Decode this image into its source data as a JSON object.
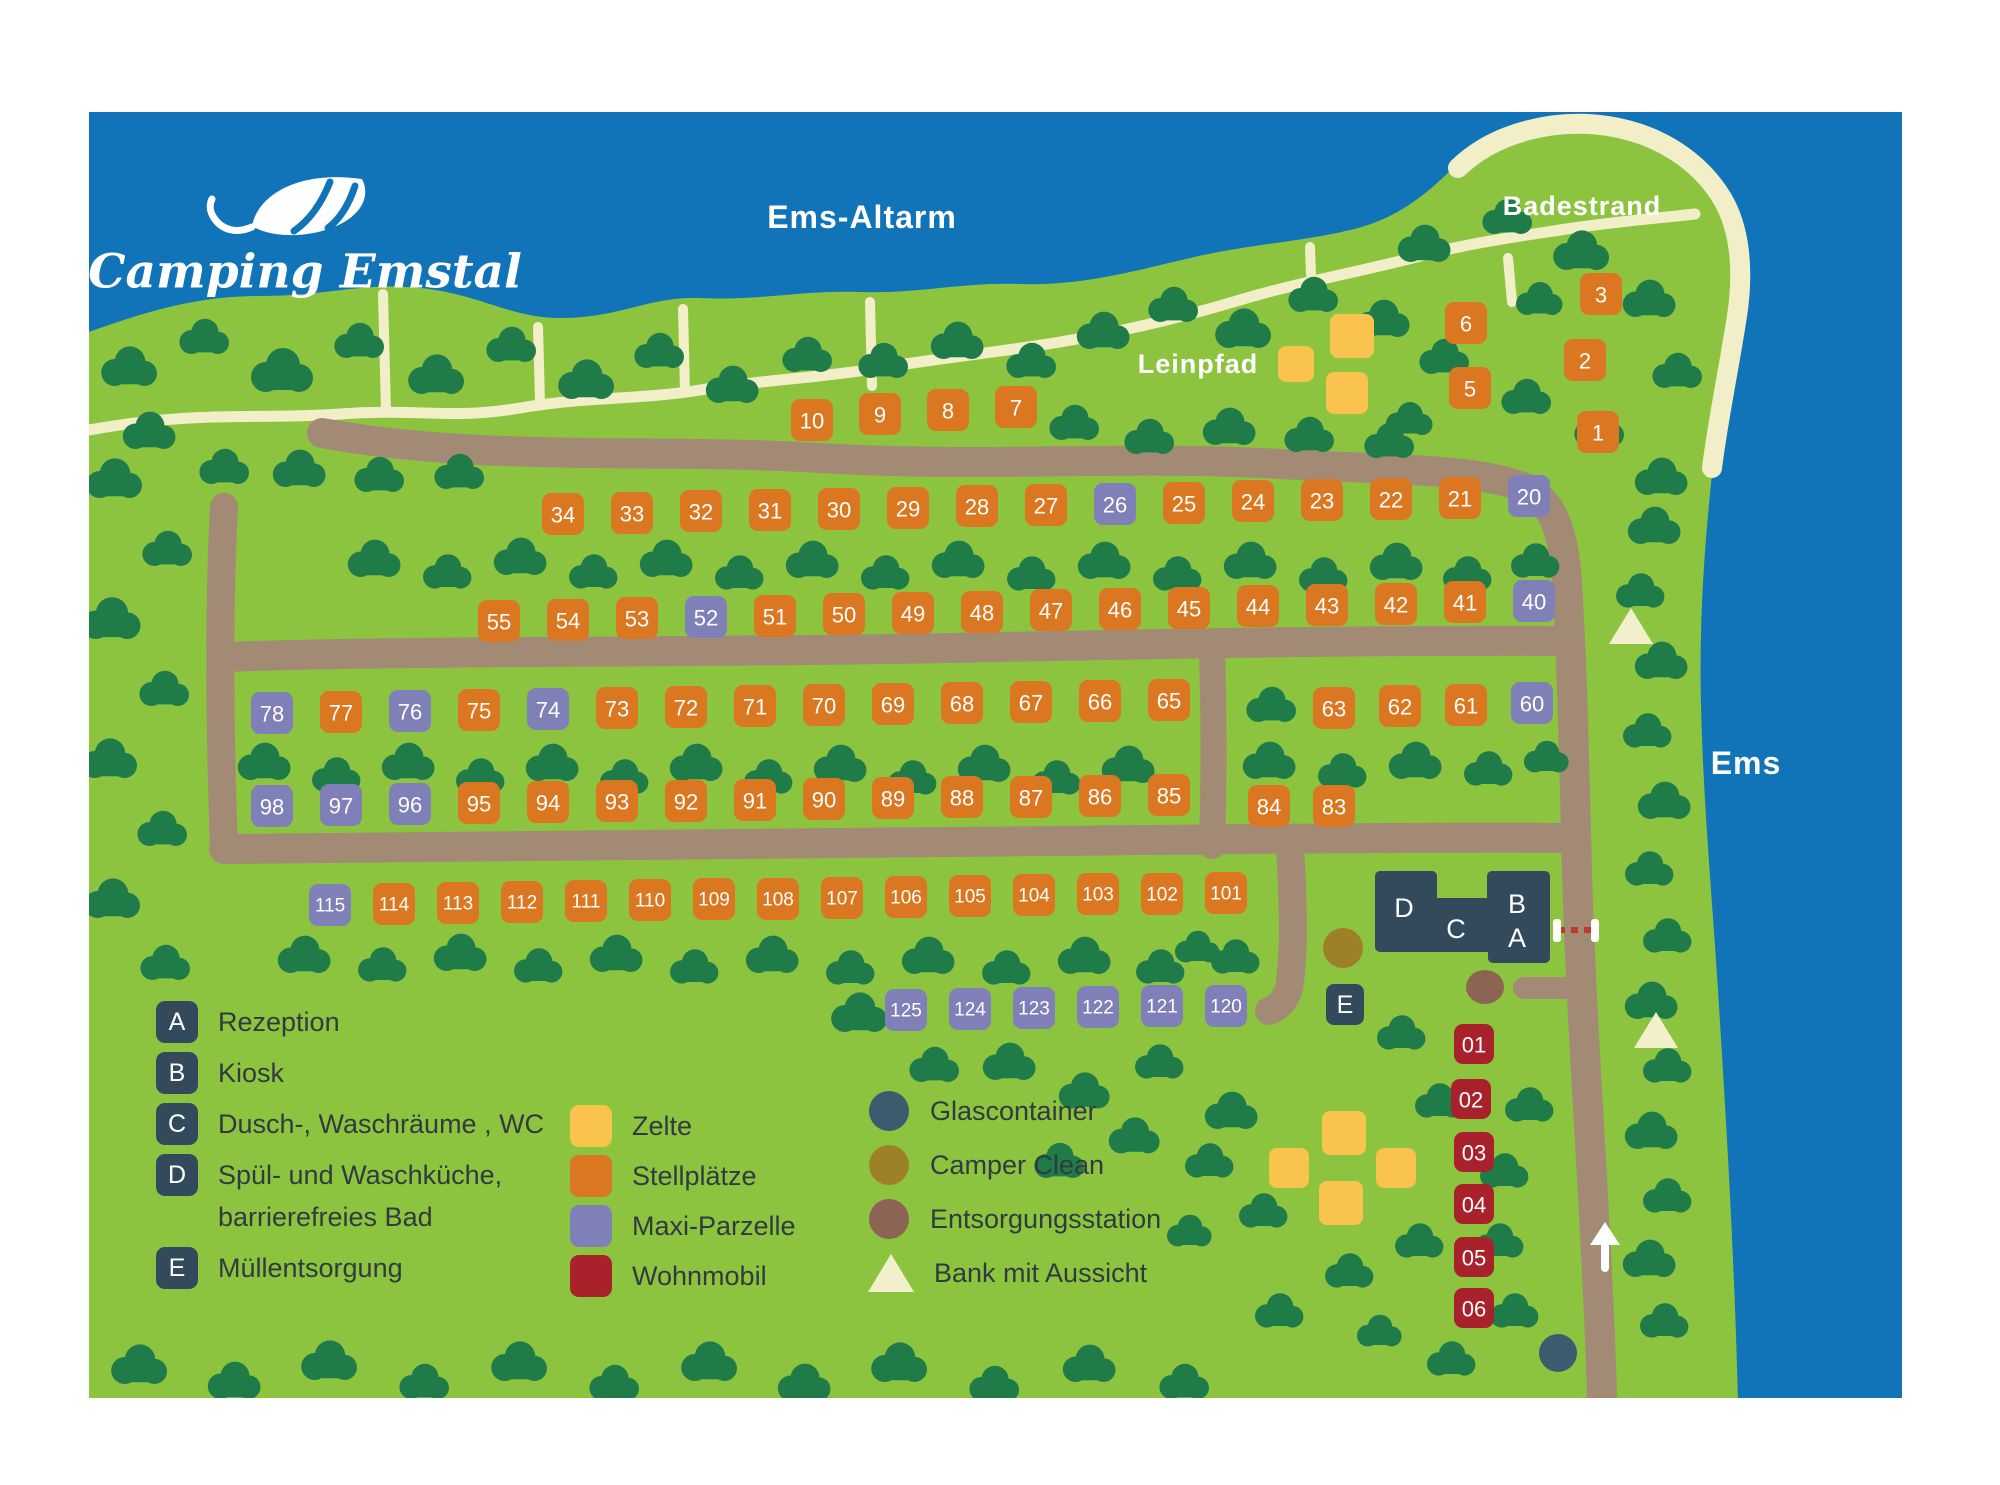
{
  "logo": {
    "title": "Camping Emstal"
  },
  "labels": {
    "water_top": "Ems-Altarm",
    "beach": "Badestrand",
    "towpath": "Leinpfad",
    "river": "Ems"
  },
  "buildings": {
    "a": "A",
    "b": "B",
    "c": "C",
    "d": "D",
    "e": "E"
  },
  "colors": {
    "water": "#1173b8",
    "land": "#8cc440",
    "tree": "#1f7c48",
    "road": "#a28a75",
    "path": "#f1eec8",
    "beach": "#f1eec8",
    "stellplatz": "#db7720",
    "maxi": "#8080b8",
    "wohnmobil": "#a8212b",
    "tent": "#f9c34d",
    "navy": "#334a5c",
    "glascontainer": "#3d5a6e",
    "camper_clean": "#9d8028",
    "entsorgung": "#8b6454",
    "bench": "#f2f0cb",
    "text_dark": "#323a3f"
  },
  "legend_facilities": [
    {
      "key": "A",
      "label": "Rezeption"
    },
    {
      "key": "B",
      "label": "Kiosk"
    },
    {
      "key": "C",
      "label": "Dusch-, Waschräume , WC"
    },
    {
      "key": "D",
      "label": "Spül- und Waschküche,\nbarrierefreies Bad"
    },
    {
      "key": "E",
      "label": "Müllentsorgung"
    }
  ],
  "legend_types": [
    {
      "label": "Zelte",
      "color": "#f9c34d",
      "shape": "square"
    },
    {
      "label": "Stellplätze",
      "color": "#db7720",
      "shape": "square"
    },
    {
      "label": "Maxi-Parzelle",
      "color": "#8080b8",
      "shape": "square"
    },
    {
      "label": "Wohnmobil",
      "color": "#a8212b",
      "shape": "square"
    }
  ],
  "legend_points": [
    {
      "label": "Glascontainer",
      "color": "#3d5a6e",
      "shape": "circle"
    },
    {
      "label": "Camper Clean",
      "color": "#9d8028",
      "shape": "circle"
    },
    {
      "label": "Entsorgungsstation",
      "color": "#8b6454",
      "shape": "circle"
    },
    {
      "label": "Bank mit Aussicht",
      "color": "#f2f0cb",
      "shape": "triangle"
    }
  ],
  "plots": [
    [
      "10",
      812,
      420,
      "s"
    ],
    [
      "9",
      880,
      414,
      "s"
    ],
    [
      "8",
      948,
      410,
      "s"
    ],
    [
      "7",
      1016,
      407,
      "s"
    ],
    [
      "6",
      1466,
      323,
      "s"
    ],
    [
      "5",
      1470,
      388,
      "s"
    ],
    [
      "3",
      1601,
      294,
      "s"
    ],
    [
      "2",
      1585,
      360,
      "s"
    ],
    [
      "1",
      1598,
      432,
      "s"
    ],
    [
      "34",
      563,
      514,
      "s"
    ],
    [
      "33",
      632,
      513,
      "s"
    ],
    [
      "32",
      701,
      511,
      "s"
    ],
    [
      "31",
      770,
      510,
      "s"
    ],
    [
      "30",
      839,
      509,
      "s"
    ],
    [
      "29",
      908,
      508,
      "s"
    ],
    [
      "28",
      977,
      506,
      "s"
    ],
    [
      "27",
      1046,
      505,
      "s"
    ],
    [
      "26",
      1115,
      504,
      "m"
    ],
    [
      "25",
      1184,
      503,
      "s"
    ],
    [
      "24",
      1253,
      501,
      "s"
    ],
    [
      "23",
      1322,
      500,
      "s"
    ],
    [
      "22",
      1391,
      499,
      "s"
    ],
    [
      "21",
      1460,
      498,
      "s"
    ],
    [
      "20",
      1529,
      496,
      "m"
    ],
    [
      "55",
      499,
      621,
      "s"
    ],
    [
      "54",
      568,
      620,
      "s"
    ],
    [
      "53",
      637,
      618,
      "s"
    ],
    [
      "52",
      706,
      617,
      "m"
    ],
    [
      "51",
      775,
      616,
      "s"
    ],
    [
      "50",
      844,
      614,
      "s"
    ],
    [
      "49",
      913,
      613,
      "s"
    ],
    [
      "48",
      982,
      612,
      "s"
    ],
    [
      "47",
      1051,
      610,
      "s"
    ],
    [
      "46",
      1120,
      609,
      "s"
    ],
    [
      "45",
      1189,
      608,
      "s"
    ],
    [
      "44",
      1258,
      606,
      "s"
    ],
    [
      "43",
      1327,
      605,
      "s"
    ],
    [
      "42",
      1396,
      604,
      "s"
    ],
    [
      "41",
      1465,
      602,
      "s"
    ],
    [
      "40",
      1534,
      601,
      "m"
    ],
    [
      "78",
      272,
      713,
      "m"
    ],
    [
      "77",
      341,
      712,
      "s"
    ],
    [
      "76",
      410,
      711,
      "m"
    ],
    [
      "75",
      479,
      710,
      "s"
    ],
    [
      "74",
      548,
      709,
      "m"
    ],
    [
      "73",
      617,
      708,
      "s"
    ],
    [
      "72",
      686,
      707,
      "s"
    ],
    [
      "71",
      755,
      706,
      "s"
    ],
    [
      "70",
      824,
      705,
      "s"
    ],
    [
      "69",
      893,
      704,
      "s"
    ],
    [
      "68",
      962,
      703,
      "s"
    ],
    [
      "67",
      1031,
      702,
      "s"
    ],
    [
      "66",
      1100,
      701,
      "s"
    ],
    [
      "65",
      1169,
      700,
      "s"
    ],
    [
      "63",
      1334,
      708,
      "s"
    ],
    [
      "62",
      1400,
      706,
      "s"
    ],
    [
      "61",
      1466,
      705,
      "s"
    ],
    [
      "60",
      1532,
      703,
      "m"
    ],
    [
      "98",
      272,
      806,
      "m"
    ],
    [
      "97",
      341,
      805,
      "m"
    ],
    [
      "96",
      410,
      804,
      "m"
    ],
    [
      "95",
      479,
      803,
      "s"
    ],
    [
      "94",
      548,
      802,
      "s"
    ],
    [
      "93",
      617,
      801,
      "s"
    ],
    [
      "92",
      686,
      801,
      "s"
    ],
    [
      "91",
      755,
      800,
      "s"
    ],
    [
      "90",
      824,
      799,
      "s"
    ],
    [
      "89",
      893,
      798,
      "s"
    ],
    [
      "88",
      962,
      797,
      "s"
    ],
    [
      "87",
      1031,
      797,
      "s"
    ],
    [
      "86",
      1100,
      796,
      "s"
    ],
    [
      "85",
      1169,
      795,
      "s"
    ],
    [
      "84",
      1269,
      806,
      "s"
    ],
    [
      "83",
      1334,
      806,
      "s"
    ],
    [
      "115",
      330,
      905,
      "m"
    ],
    [
      "114",
      394,
      904,
      "s"
    ],
    [
      "113",
      458,
      903,
      "s"
    ],
    [
      "112",
      522,
      902,
      "s"
    ],
    [
      "111",
      586,
      901,
      "s"
    ],
    [
      "110",
      650,
      900,
      "s"
    ],
    [
      "109",
      714,
      899,
      "s"
    ],
    [
      "108",
      778,
      899,
      "s"
    ],
    [
      "107",
      842,
      898,
      "s"
    ],
    [
      "106",
      906,
      897,
      "s"
    ],
    [
      "105",
      970,
      896,
      "s"
    ],
    [
      "104",
      1034,
      895,
      "s"
    ],
    [
      "103",
      1098,
      894,
      "s"
    ],
    [
      "102",
      1162,
      894,
      "s"
    ],
    [
      "101",
      1226,
      893,
      "s"
    ],
    [
      "125",
      906,
      1010,
      "m"
    ],
    [
      "124",
      970,
      1009,
      "m"
    ],
    [
      "123",
      1034,
      1008,
      "m"
    ],
    [
      "122",
      1098,
      1007,
      "m"
    ],
    [
      "121",
      1162,
      1006,
      "m"
    ],
    [
      "120",
      1226,
      1006,
      "m"
    ],
    [
      "01",
      1474,
      1044,
      "w"
    ],
    [
      "02",
      1471,
      1099,
      "w"
    ],
    [
      "03",
      1474,
      1152,
      "w"
    ],
    [
      "04",
      1474,
      1204,
      "w"
    ],
    [
      "05",
      1474,
      1257,
      "w"
    ],
    [
      "06",
      1474,
      1308,
      "w"
    ]
  ],
  "tents": [
    [
      1296,
      364,
      36
    ],
    [
      1352,
      336,
      44
    ],
    [
      1347,
      393,
      42
    ],
    [
      1289,
      1168,
      40
    ],
    [
      1344,
      1133,
      44
    ],
    [
      1341,
      1203,
      44
    ],
    [
      1396,
      1168,
      40
    ]
  ],
  "benches": [
    {
      "x": 1631,
      "y": 627
    },
    {
      "x": 1656,
      "y": 1031
    }
  ],
  "points": {
    "camper_clean": {
      "x": 1343,
      "y": 948
    },
    "entsorgung": {
      "x": 1485,
      "y": 987
    },
    "glascontainer": {
      "x": 1558,
      "y": 1353
    }
  },
  "trees": [
    [
      130,
      368,
      0.9
    ],
    [
      205,
      338,
      0.8
    ],
    [
      283,
      372,
      1.0
    ],
    [
      360,
      342,
      0.8
    ],
    [
      437,
      376,
      0.9
    ],
    [
      512,
      346,
      0.8
    ],
    [
      587,
      381,
      0.9
    ],
    [
      660,
      352,
      0.8
    ],
    [
      733,
      386,
      0.85
    ],
    [
      808,
      356,
      0.8
    ],
    [
      884,
      362,
      0.8
    ],
    [
      958,
      342,
      0.85
    ],
    [
      1032,
      362,
      0.8
    ],
    [
      1104,
      332,
      0.85
    ],
    [
      1174,
      306,
      0.8
    ],
    [
      1244,
      330,
      0.9
    ],
    [
      1314,
      296,
      0.8
    ],
    [
      1384,
      320,
      0.85
    ],
    [
      1425,
      245,
      0.85
    ],
    [
      1508,
      218,
      0.8
    ],
    [
      1582,
      252,
      0.9
    ],
    [
      1650,
      300,
      0.85
    ],
    [
      1678,
      372,
      0.8
    ],
    [
      1540,
      300,
      0.75
    ],
    [
      1445,
      358,
      0.8
    ],
    [
      1527,
      398,
      0.8
    ],
    [
      1600,
      430,
      0.8
    ],
    [
      1662,
      478,
      0.85
    ],
    [
      1410,
      420,
      0.75
    ],
    [
      1075,
      424,
      0.8
    ],
    [
      1150,
      438,
      0.8
    ],
    [
      1230,
      428,
      0.85
    ],
    [
      1310,
      436,
      0.8
    ],
    [
      1390,
      442,
      0.8
    ],
    [
      150,
      432,
      0.85
    ],
    [
      225,
      468,
      0.8
    ],
    [
      300,
      470,
      0.85
    ],
    [
      380,
      476,
      0.8
    ],
    [
      460,
      473,
      0.8
    ],
    [
      375,
      560,
      0.85
    ],
    [
      448,
      573,
      0.78
    ],
    [
      521,
      558,
      0.85
    ],
    [
      594,
      573,
      0.78
    ],
    [
      667,
      560,
      0.85
    ],
    [
      740,
      574,
      0.78
    ],
    [
      813,
      561,
      0.85
    ],
    [
      886,
      574,
      0.78
    ],
    [
      959,
      561,
      0.85
    ],
    [
      1032,
      575,
      0.78
    ],
    [
      1105,
      562,
      0.85
    ],
    [
      1178,
      575,
      0.78
    ],
    [
      1251,
      562,
      0.85
    ],
    [
      1324,
      576,
      0.78
    ],
    [
      1397,
      563,
      0.85
    ],
    [
      1468,
      575,
      0.78
    ],
    [
      1536,
      562,
      0.78
    ],
    [
      115,
      480,
      0.9
    ],
    [
      168,
      550,
      0.8
    ],
    [
      112,
      620,
      0.95
    ],
    [
      165,
      690,
      0.8
    ],
    [
      110,
      760,
      0.9
    ],
    [
      163,
      830,
      0.8
    ],
    [
      113,
      900,
      0.9
    ],
    [
      166,
      964,
      0.8
    ],
    [
      265,
      763,
      0.85
    ],
    [
      337,
      776,
      0.78
    ],
    [
      409,
      763,
      0.85
    ],
    [
      481,
      777,
      0.78
    ],
    [
      553,
      764,
      0.85
    ],
    [
      625,
      778,
      0.78
    ],
    [
      697,
      764,
      0.85
    ],
    [
      769,
      778,
      0.78
    ],
    [
      841,
      765,
      0.85
    ],
    [
      913,
      779,
      0.78
    ],
    [
      985,
      765,
      0.85
    ],
    [
      1057,
      779,
      0.78
    ],
    [
      1129,
      766,
      0.85
    ],
    [
      1272,
      706,
      0.8
    ],
    [
      1270,
      762,
      0.85
    ],
    [
      1343,
      772,
      0.78
    ],
    [
      1416,
      762,
      0.85
    ],
    [
      1489,
      770,
      0.78
    ],
    [
      1547,
      758,
      0.72
    ],
    [
      305,
      956,
      0.85
    ],
    [
      383,
      966,
      0.78
    ],
    [
      461,
      954,
      0.85
    ],
    [
      539,
      967,
      0.78
    ],
    [
      617,
      955,
      0.85
    ],
    [
      695,
      968,
      0.78
    ],
    [
      773,
      956,
      0.85
    ],
    [
      851,
      969,
      0.78
    ],
    [
      929,
      957,
      0.85
    ],
    [
      1007,
      969,
      0.78
    ],
    [
      1085,
      957,
      0.85
    ],
    [
      1161,
      968,
      0.78
    ],
    [
      1236,
      958,
      0.78
    ],
    [
      860,
      1014,
      0.9
    ],
    [
      935,
      1066,
      0.8
    ],
    [
      1010,
      1063,
      0.85
    ],
    [
      1085,
      1092,
      0.82
    ],
    [
      1160,
      1063,
      0.78
    ],
    [
      1232,
      1112,
      0.85
    ],
    [
      1060,
      1162,
      0.8
    ],
    [
      1135,
      1137,
      0.82
    ],
    [
      1198,
      948,
      0.72
    ],
    [
      1402,
      1034,
      0.78
    ],
    [
      1210,
      1162,
      0.78
    ],
    [
      1264,
      1212,
      0.78
    ],
    [
      1190,
      1232,
      0.72
    ],
    [
      1420,
      1242,
      0.78
    ],
    [
      1350,
      1272,
      0.78
    ],
    [
      1280,
      1312,
      0.78
    ],
    [
      1440,
      1102,
      0.78
    ],
    [
      1530,
      1106,
      0.78
    ],
    [
      1505,
      1172,
      0.78
    ],
    [
      1500,
      1242,
      0.78
    ],
    [
      1515,
      1312,
      0.78
    ],
    [
      1452,
      1360,
      0.78
    ],
    [
      1380,
      1332,
      0.72
    ],
    [
      1655,
      527,
      0.85
    ],
    [
      1641,
      592,
      0.78
    ],
    [
      1662,
      662,
      0.85
    ],
    [
      1648,
      732,
      0.78
    ],
    [
      1665,
      802,
      0.85
    ],
    [
      1650,
      870,
      0.78
    ],
    [
      1668,
      937,
      0.78
    ],
    [
      1652,
      1002,
      0.85
    ],
    [
      1668,
      1067,
      0.78
    ],
    [
      1652,
      1132,
      0.85
    ],
    [
      1668,
      1197,
      0.78
    ],
    [
      1650,
      1260,
      0.85
    ],
    [
      1665,
      1322,
      0.78
    ],
    [
      140,
      1366,
      0.9
    ],
    [
      235,
      1382,
      0.85
    ],
    [
      330,
      1362,
      0.9
    ],
    [
      425,
      1383,
      0.8
    ],
    [
      520,
      1363,
      0.9
    ],
    [
      615,
      1384,
      0.8
    ],
    [
      710,
      1363,
      0.9
    ],
    [
      805,
      1384,
      0.85
    ],
    [
      900,
      1364,
      0.9
    ],
    [
      995,
      1385,
      0.8
    ],
    [
      1090,
      1365,
      0.85
    ],
    [
      1185,
      1383,
      0.8
    ]
  ]
}
